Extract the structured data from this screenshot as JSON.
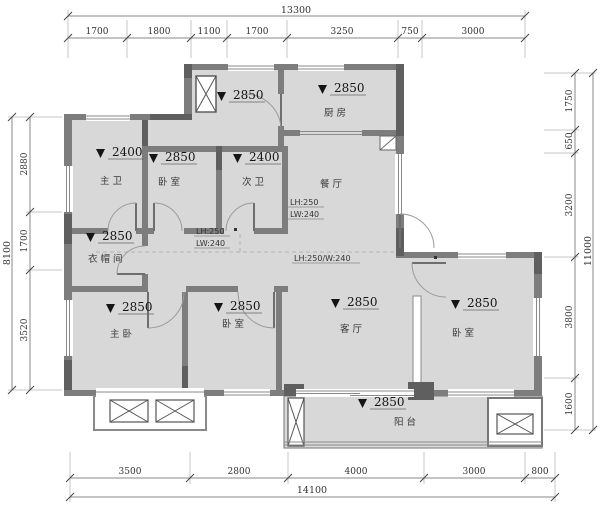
{
  "plan_type": "apartment-floor-plan",
  "colors": {
    "background": "#ffffff",
    "room_fill": "#d8d8d8",
    "wall": "#7d7d7d",
    "wall_dark": "#5f5f5f",
    "dim_line": "#888888",
    "text": "#151515"
  },
  "rooms": {
    "entry": {
      "elev": "2850"
    },
    "kitchen": {
      "name": "厨房",
      "elev": "2850"
    },
    "master_bath": {
      "name": "主卫",
      "elev": "2400"
    },
    "bedroom_top": {
      "name": "卧室",
      "elev": "2850"
    },
    "second_bath": {
      "name": "次卫",
      "elev": "2400"
    },
    "dining": {
      "name": "餐厅"
    },
    "cloakroom": {
      "name": "衣帽间",
      "elev": "2850"
    },
    "master_bedroom": {
      "name": "主卧",
      "elev": "2850"
    },
    "bedroom_mid": {
      "name": "卧室",
      "elev": "2850"
    },
    "living": {
      "name": "客厅",
      "elev": "2850"
    },
    "bedroom_right": {
      "name": "卧室",
      "elev": "2850"
    },
    "balcony": {
      "name": "阳台",
      "elev": "2850"
    }
  },
  "annotations": {
    "beam_a_line1": "LH:250",
    "beam_a_line2": "LW:240",
    "beam_b_line1": "LH:250",
    "beam_b_line2": "LW:240",
    "beam_c": "LH:250/W:240"
  },
  "dimensions": {
    "top": {
      "overall": "13300",
      "segments": [
        "1700",
        "1800",
        "1100",
        "1700",
        "3250",
        "750",
        "3000"
      ]
    },
    "bottom": {
      "overall": "14100",
      "segments": [
        "3500",
        "2800",
        "4000",
        "3000",
        "800"
      ]
    },
    "left": {
      "overall": "8100",
      "segments": [
        "2880",
        "1700",
        "3520"
      ]
    },
    "right": {
      "overall": "11000",
      "segments": [
        "1750",
        "650",
        "3200",
        "3800",
        "1600"
      ]
    }
  }
}
